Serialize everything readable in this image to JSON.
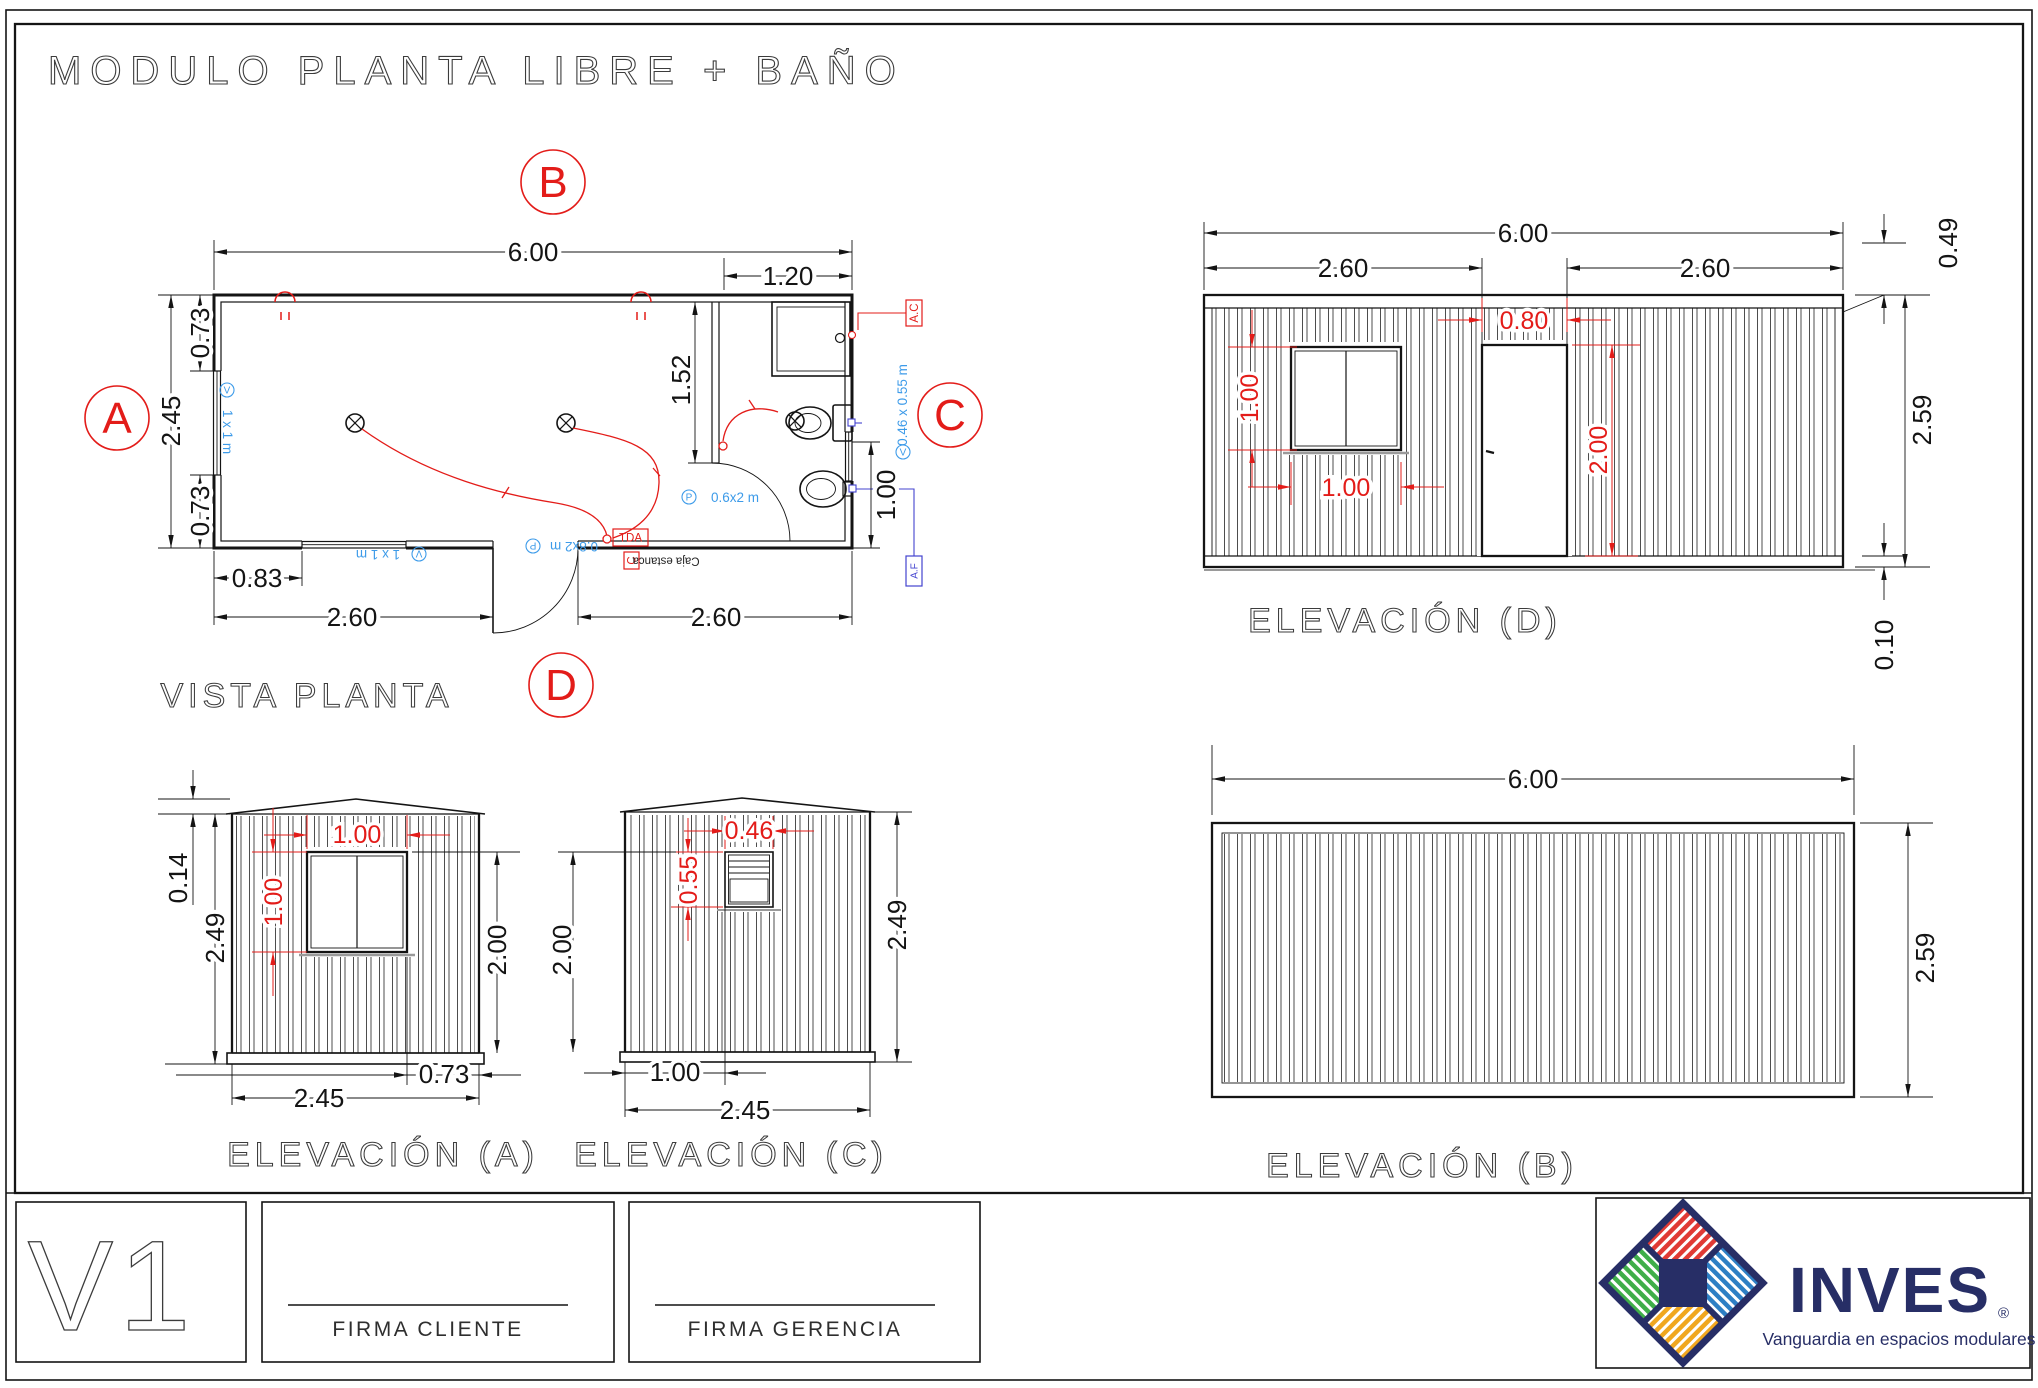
{
  "title": "MODULO  PLANTA LIBRE + BAÑO",
  "colors": {
    "line_black": "#141414",
    "dim_red": "#e31c19",
    "note_blue": "#3d9be9",
    "cold_water_blue": "#4343cf",
    "brand_navy": "#272e66",
    "logo_red": "#e03a34",
    "logo_blue": "#2d7fc4",
    "logo_green": "#3fae49",
    "logo_yellow": "#f0a71f"
  },
  "section_markers": {
    "a": "A",
    "b": "B",
    "c": "C",
    "d": "D"
  },
  "plan": {
    "caption": "VISTA PLANTA",
    "dims": {
      "total_width": "6.00",
      "bath_width": "1.20",
      "depth": "2.45",
      "top_offset": "0.73",
      "bottom_offset": "0.73",
      "bath_depth": "1.52",
      "bath_clear": "1.00",
      "window_offset": "0.83",
      "span_left": "2.60",
      "span_right": "2.60"
    },
    "annotations": {
      "v": "V",
      "p": "P",
      "window_left": "1 x 1 m",
      "window_bottom": "1 x 1 m",
      "door_main": "0.8x2 m",
      "door_bath": "0.6x2 m",
      "window_bath": "0.46 x 0.55 m",
      "hot_water": "A.C",
      "cold_water": "A.F",
      "tda": "TDA",
      "circuit": "C",
      "junction_box": "Caja estanca"
    }
  },
  "elevation_d": {
    "caption": "ELEVACIÓN (D)",
    "dims": {
      "total": "6.00",
      "left": "2.60",
      "right": "2.60",
      "door_width": "0.80",
      "door_height": "2.00",
      "window_width": "1.00",
      "window_height": "1.00",
      "roof": "0.49",
      "height": "2.59",
      "base": "0.10"
    }
  },
  "elevation_a": {
    "caption": "ELEVACIÓN (A)",
    "dims": {
      "roof": "0.14",
      "height": "2.49",
      "window_width": "1.00",
      "window_height": "1.00",
      "wall": "2.00",
      "offset": "0.73",
      "width": "2.45"
    }
  },
  "elevation_c": {
    "caption": "ELEVACIÓN (C)",
    "dims": {
      "window_width": "0.46",
      "window_height": "0.55",
      "wall": "2.00",
      "height": "2.49",
      "offset": "1.00",
      "width": "2.45"
    }
  },
  "elevation_b": {
    "caption": "ELEVACIÓN (B)",
    "dims": {
      "width": "6.00",
      "height": "2.59"
    }
  },
  "titleblock": {
    "version": "V1",
    "firma_cliente": "FIRMA CLIENTE",
    "firma_gerencia": "FIRMA GERENCIA",
    "brand": "INVES",
    "registered": "®",
    "tagline": "Vanguardia en espacios modulares"
  }
}
